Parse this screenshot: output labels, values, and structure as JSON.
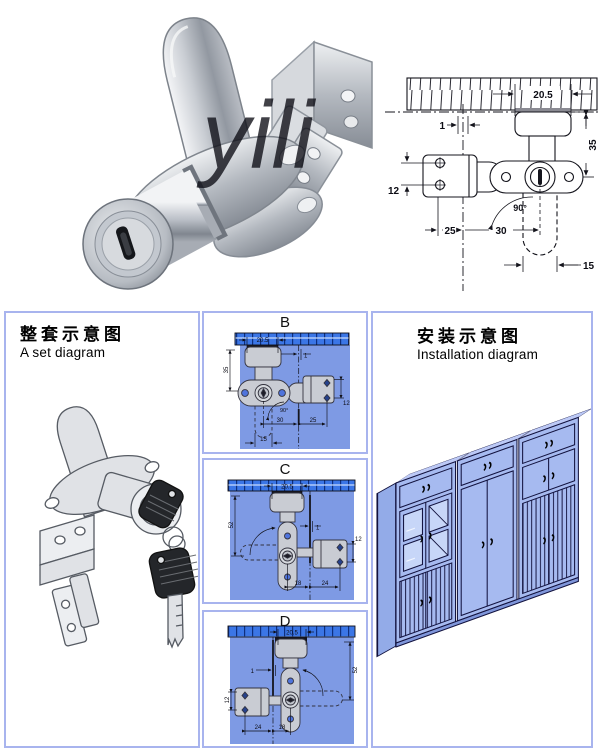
{
  "photo": {
    "watermark": "yili"
  },
  "set_panel": {
    "title_zh": "整套示意图",
    "title_en": "A set diagram"
  },
  "install_panel": {
    "title_zh": "安装示意图",
    "title_en": "Installation diagram"
  },
  "spec_diagram": {
    "slot_width": "20.5",
    "edge_gap": "1",
    "depth": "35",
    "bracket_hole_pitch": "12",
    "left_offset": "25",
    "right_offset": "30",
    "cam_width": "15",
    "rotation_angle": "90°"
  },
  "variants": {
    "b": {
      "label": "B",
      "slot_width": "20.5",
      "edge_gap": "1",
      "depth": "35",
      "bracket_hole_pitch": "12",
      "right_offset": "30",
      "left_offset": "25",
      "cam_width": "15",
      "rotation_angle": "90°"
    },
    "c": {
      "label": "C",
      "slot_width": "20.5",
      "edge_gap": "1",
      "depth": "52",
      "bracket_hole_pitch": "12",
      "offset_a": "18",
      "offset_b": "24"
    },
    "d": {
      "label": "D",
      "slot_width": "20.5",
      "edge_gap": "1",
      "depth": "52",
      "bracket_hole_pitch": "12",
      "offset_a": "24",
      "offset_b": "18"
    }
  },
  "colors": {
    "panel_border": "#a8b4ee",
    "diagram_bg": "#7e9ae4",
    "bar_blue": "#3b76e6",
    "cabinet_blue": "#a6baf0",
    "metal": "#c9ccd3"
  }
}
